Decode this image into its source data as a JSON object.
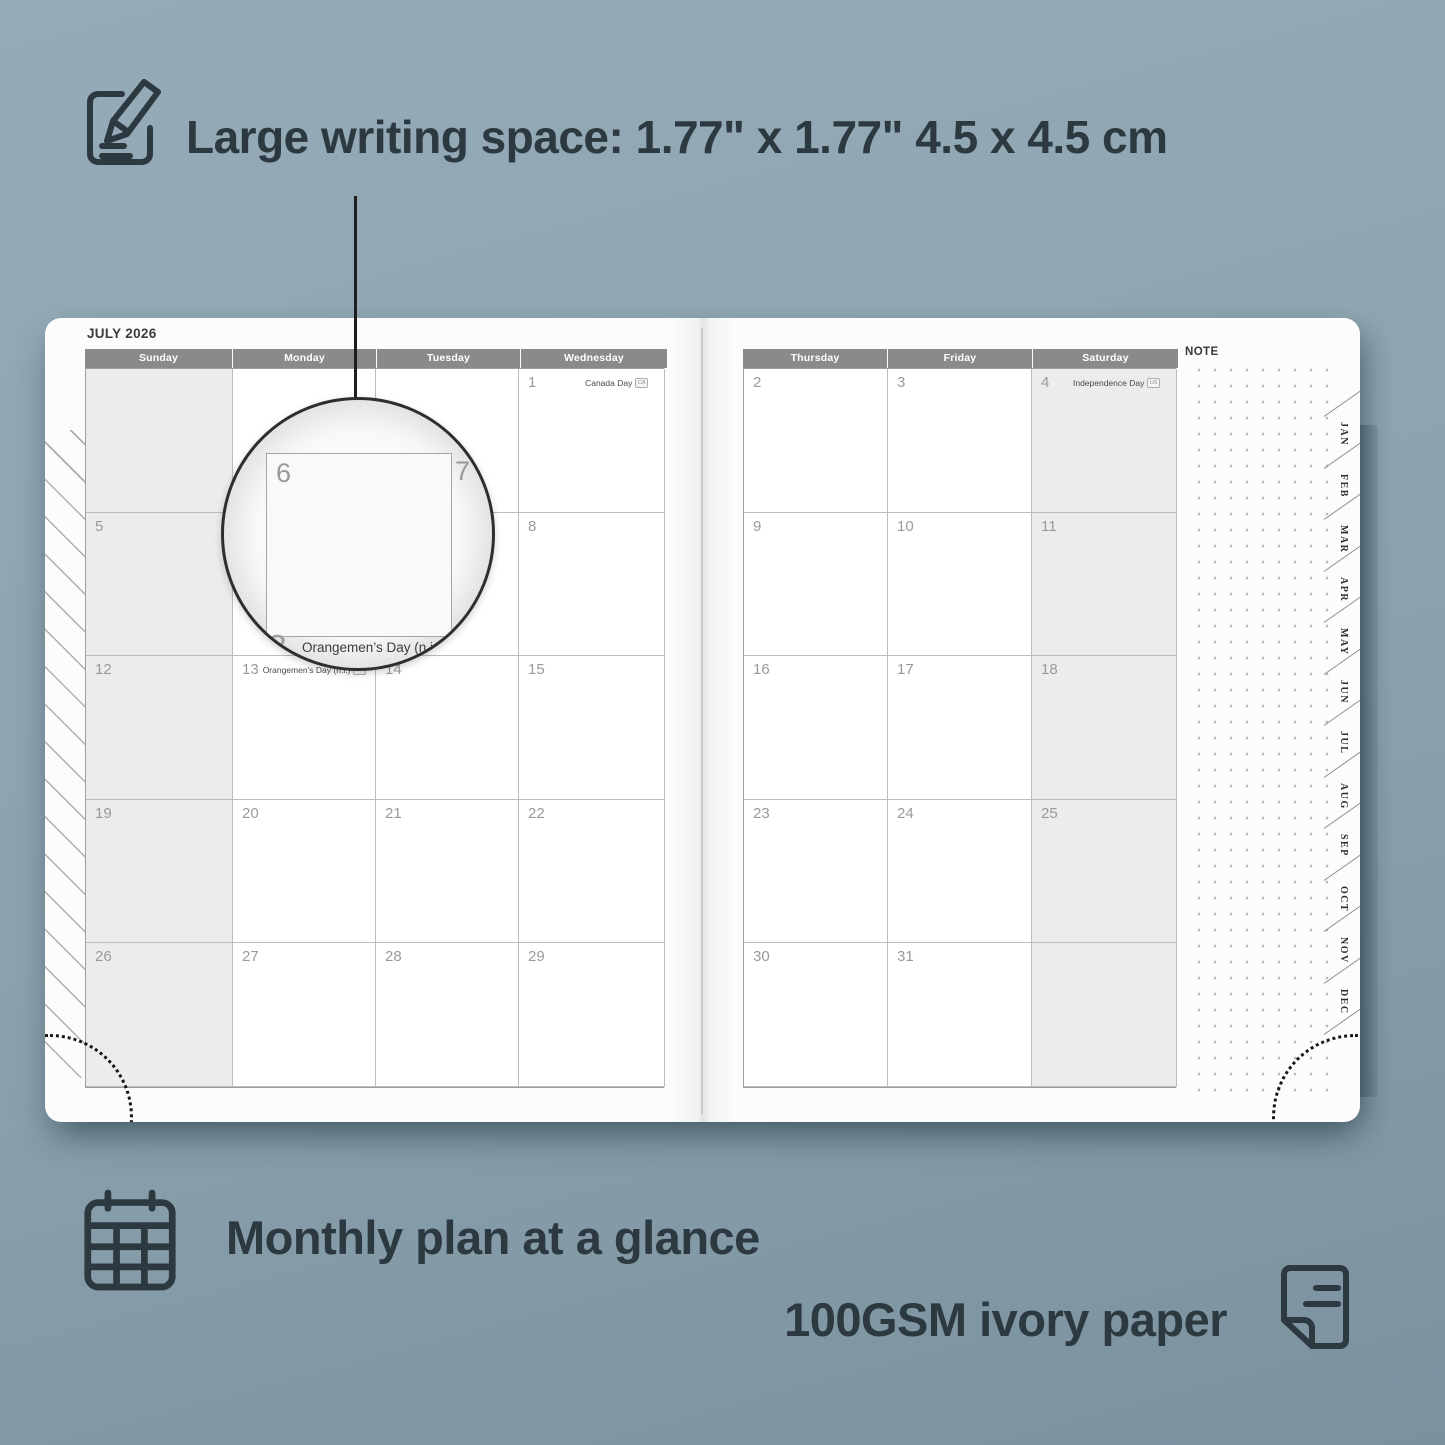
{
  "colors": {
    "background": "#8ca3af",
    "ink": "#2c3940",
    "page": "#fcfcfc",
    "header_bar": "#8a8a8a",
    "weekend_fill": "#ececec",
    "grid_line": "#bcbcbc",
    "day_number": "#9a9a9a"
  },
  "hero": {
    "title": "Large writing space: 1.77\" x 1.77\" 4.5 x 4.5 cm"
  },
  "footer": {
    "monthly_label": "Monthly plan at a glance",
    "paper_label": "100GSM ivory paper"
  },
  "planner": {
    "month_title": "JULY 2026",
    "note_label": "NOTE",
    "weekday_headers_left": [
      "Sunday",
      "Monday",
      "Tuesday",
      "Wednesday"
    ],
    "weekday_headers_right": [
      "Thursday",
      "Friday",
      "Saturday"
    ],
    "month_tabs": [
      "JAN",
      "FEB",
      "MAR",
      "APR",
      "MAY",
      "JUN",
      "JUL",
      "AUG",
      "SEP",
      "OCT",
      "NOV",
      "DEC"
    ],
    "left_grid": [
      [
        {
          "n": ""
        },
        {
          "n": ""
        },
        {
          "n": ""
        },
        {
          "n": "1",
          "holiday": "Canada Day",
          "badge": "CA",
          "holiday_align": "right"
        }
      ],
      [
        {
          "n": "5"
        },
        {
          "n": "6"
        },
        {
          "n": "7"
        },
        {
          "n": "8"
        }
      ],
      [
        {
          "n": "12"
        },
        {
          "n": "13",
          "holiday": "Orangemen’s Day (n.i.)",
          "badge": "UK",
          "holiday_align": "left"
        },
        {
          "n": "14"
        },
        {
          "n": "15"
        }
      ],
      [
        {
          "n": "19"
        },
        {
          "n": "20"
        },
        {
          "n": "21"
        },
        {
          "n": "22"
        }
      ],
      [
        {
          "n": "26"
        },
        {
          "n": "27"
        },
        {
          "n": "28"
        },
        {
          "n": "29"
        }
      ]
    ],
    "right_grid": [
      [
        {
          "n": "2"
        },
        {
          "n": "3"
        },
        {
          "n": "4",
          "holiday": "Independence Day",
          "badge": "US",
          "holiday_align": "right"
        }
      ],
      [
        {
          "n": "9"
        },
        {
          "n": "10"
        },
        {
          "n": "11"
        }
      ],
      [
        {
          "n": "16"
        },
        {
          "n": "17"
        },
        {
          "n": "18"
        }
      ],
      [
        {
          "n": "23"
        },
        {
          "n": "24"
        },
        {
          "n": "25"
        }
      ],
      [
        {
          "n": "30"
        },
        {
          "n": "31"
        },
        {
          "n": ""
        }
      ]
    ],
    "weekend_columns_left": [
      0
    ],
    "weekend_columns_right": [
      2
    ]
  },
  "magnifier": {
    "day_left": "6",
    "day_right": "7",
    "day_below": "13",
    "holiday": "Orangemen’s Day (n.i.)",
    "badge": "UK"
  }
}
